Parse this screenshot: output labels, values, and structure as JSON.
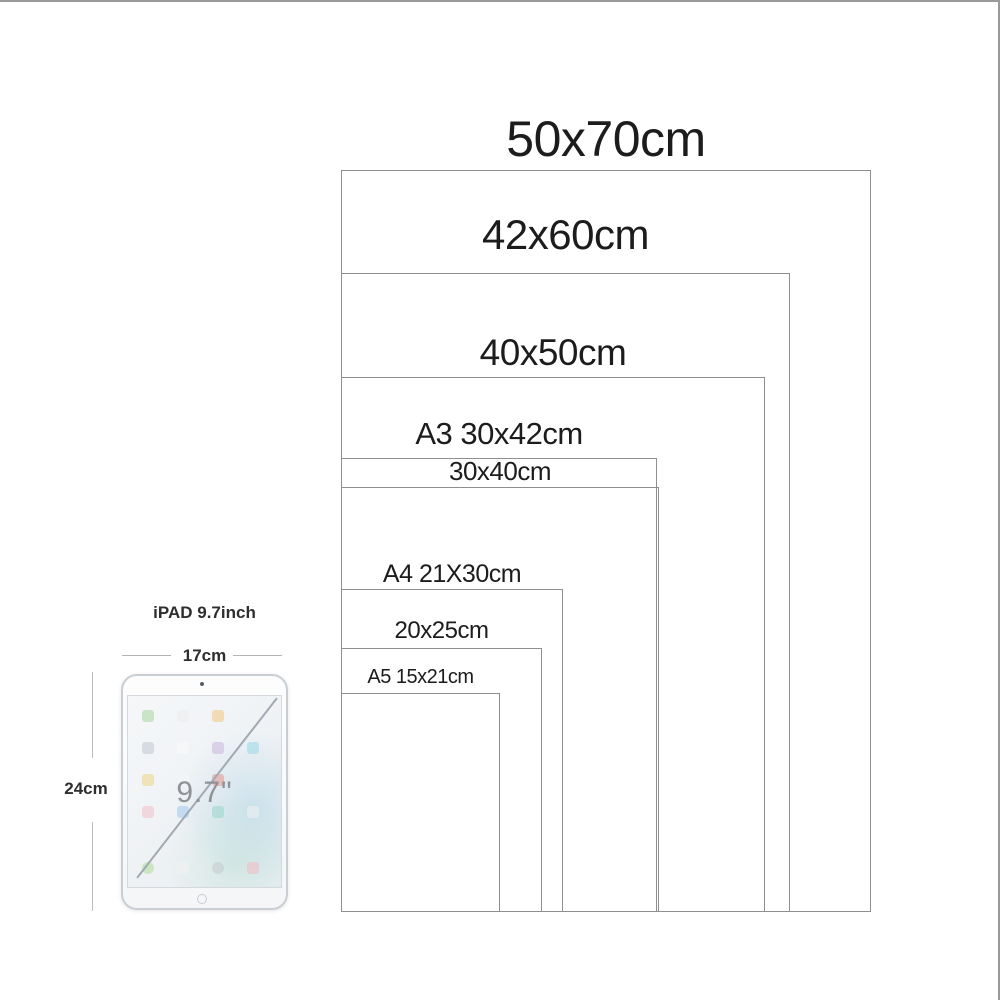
{
  "page": {
    "background": "#ffffff",
    "top_border_color": "#9a9a9a",
    "right_border_color": "#9a9a9a"
  },
  "size_chart": {
    "line_color": "#8f8f8f",
    "text_color": "#1c1c1c",
    "items": [
      {
        "id": "50x70",
        "label": "50x70cm",
        "width_cm": 50,
        "height_cm": 70,
        "left": 341,
        "top": 170,
        "width": 530,
        "height": 742,
        "font_size": 50,
        "label_top": 112
      },
      {
        "id": "42x60",
        "label": "42x60cm",
        "width_cm": 42,
        "height_cm": 60,
        "left": 341,
        "top": 273,
        "width": 449,
        "height": 639,
        "font_size": 42,
        "label_top": 212
      },
      {
        "id": "40x50",
        "label": "40x50cm",
        "width_cm": 40,
        "height_cm": 50,
        "left": 341,
        "top": 377,
        "width": 424,
        "height": 535,
        "font_size": 37,
        "label_top": 333
      },
      {
        "id": "a3-30x42",
        "label": "A3 30x42cm",
        "width_cm": 30,
        "height_cm": 42,
        "left": 341,
        "top": 458,
        "width": 316,
        "height": 454,
        "font_size": 31,
        "label_top": 417
      },
      {
        "id": "30x40",
        "label": "30x40cm",
        "width_cm": 30,
        "height_cm": 40,
        "left": 341,
        "top": 487,
        "width": 318,
        "height": 425,
        "font_size": 26,
        "label_top": 457
      },
      {
        "id": "a4-21x30",
        "label": "A4 21X30cm",
        "width_cm": 21,
        "height_cm": 30,
        "left": 341,
        "top": 589,
        "width": 222,
        "height": 323,
        "font_size": 25,
        "label_top": 561
      },
      {
        "id": "20x25",
        "label": "20x25cm",
        "width_cm": 20,
        "height_cm": 25,
        "left": 341,
        "top": 648,
        "width": 201,
        "height": 264,
        "font_size": 24,
        "label_top": 618
      },
      {
        "id": "a5-15x21",
        "label": "A5 15x21cm",
        "width_cm": 15,
        "height_cm": 21,
        "left": 341,
        "top": 693,
        "width": 159,
        "height": 219,
        "font_size": 20,
        "label_top": 667
      }
    ]
  },
  "ipad": {
    "title": "iPAD 9.7inch",
    "width_label": "17cm",
    "height_label": "24cm",
    "screen_label": "9.7\"",
    "icon_rows": [
      [
        "#aed9a6",
        "#ededed",
        "#f2c98a",
        "#f2f2f2"
      ],
      [
        "#c3cbd3",
        "#fafafa",
        "#cdb9dd",
        "#9fdbe8"
      ],
      [
        "#ecd98f",
        "#f5f5f5",
        "#e89a94",
        "#d8e8f0"
      ],
      [
        "#f2c3cf",
        "#a9cdf0",
        "#9cd8cf",
        "#eef0f0"
      ]
    ],
    "dock_icons": [
      "#b3e0a1",
      "#f0f0f0",
      "#c8ccd0",
      "#f2bcc4"
    ]
  }
}
